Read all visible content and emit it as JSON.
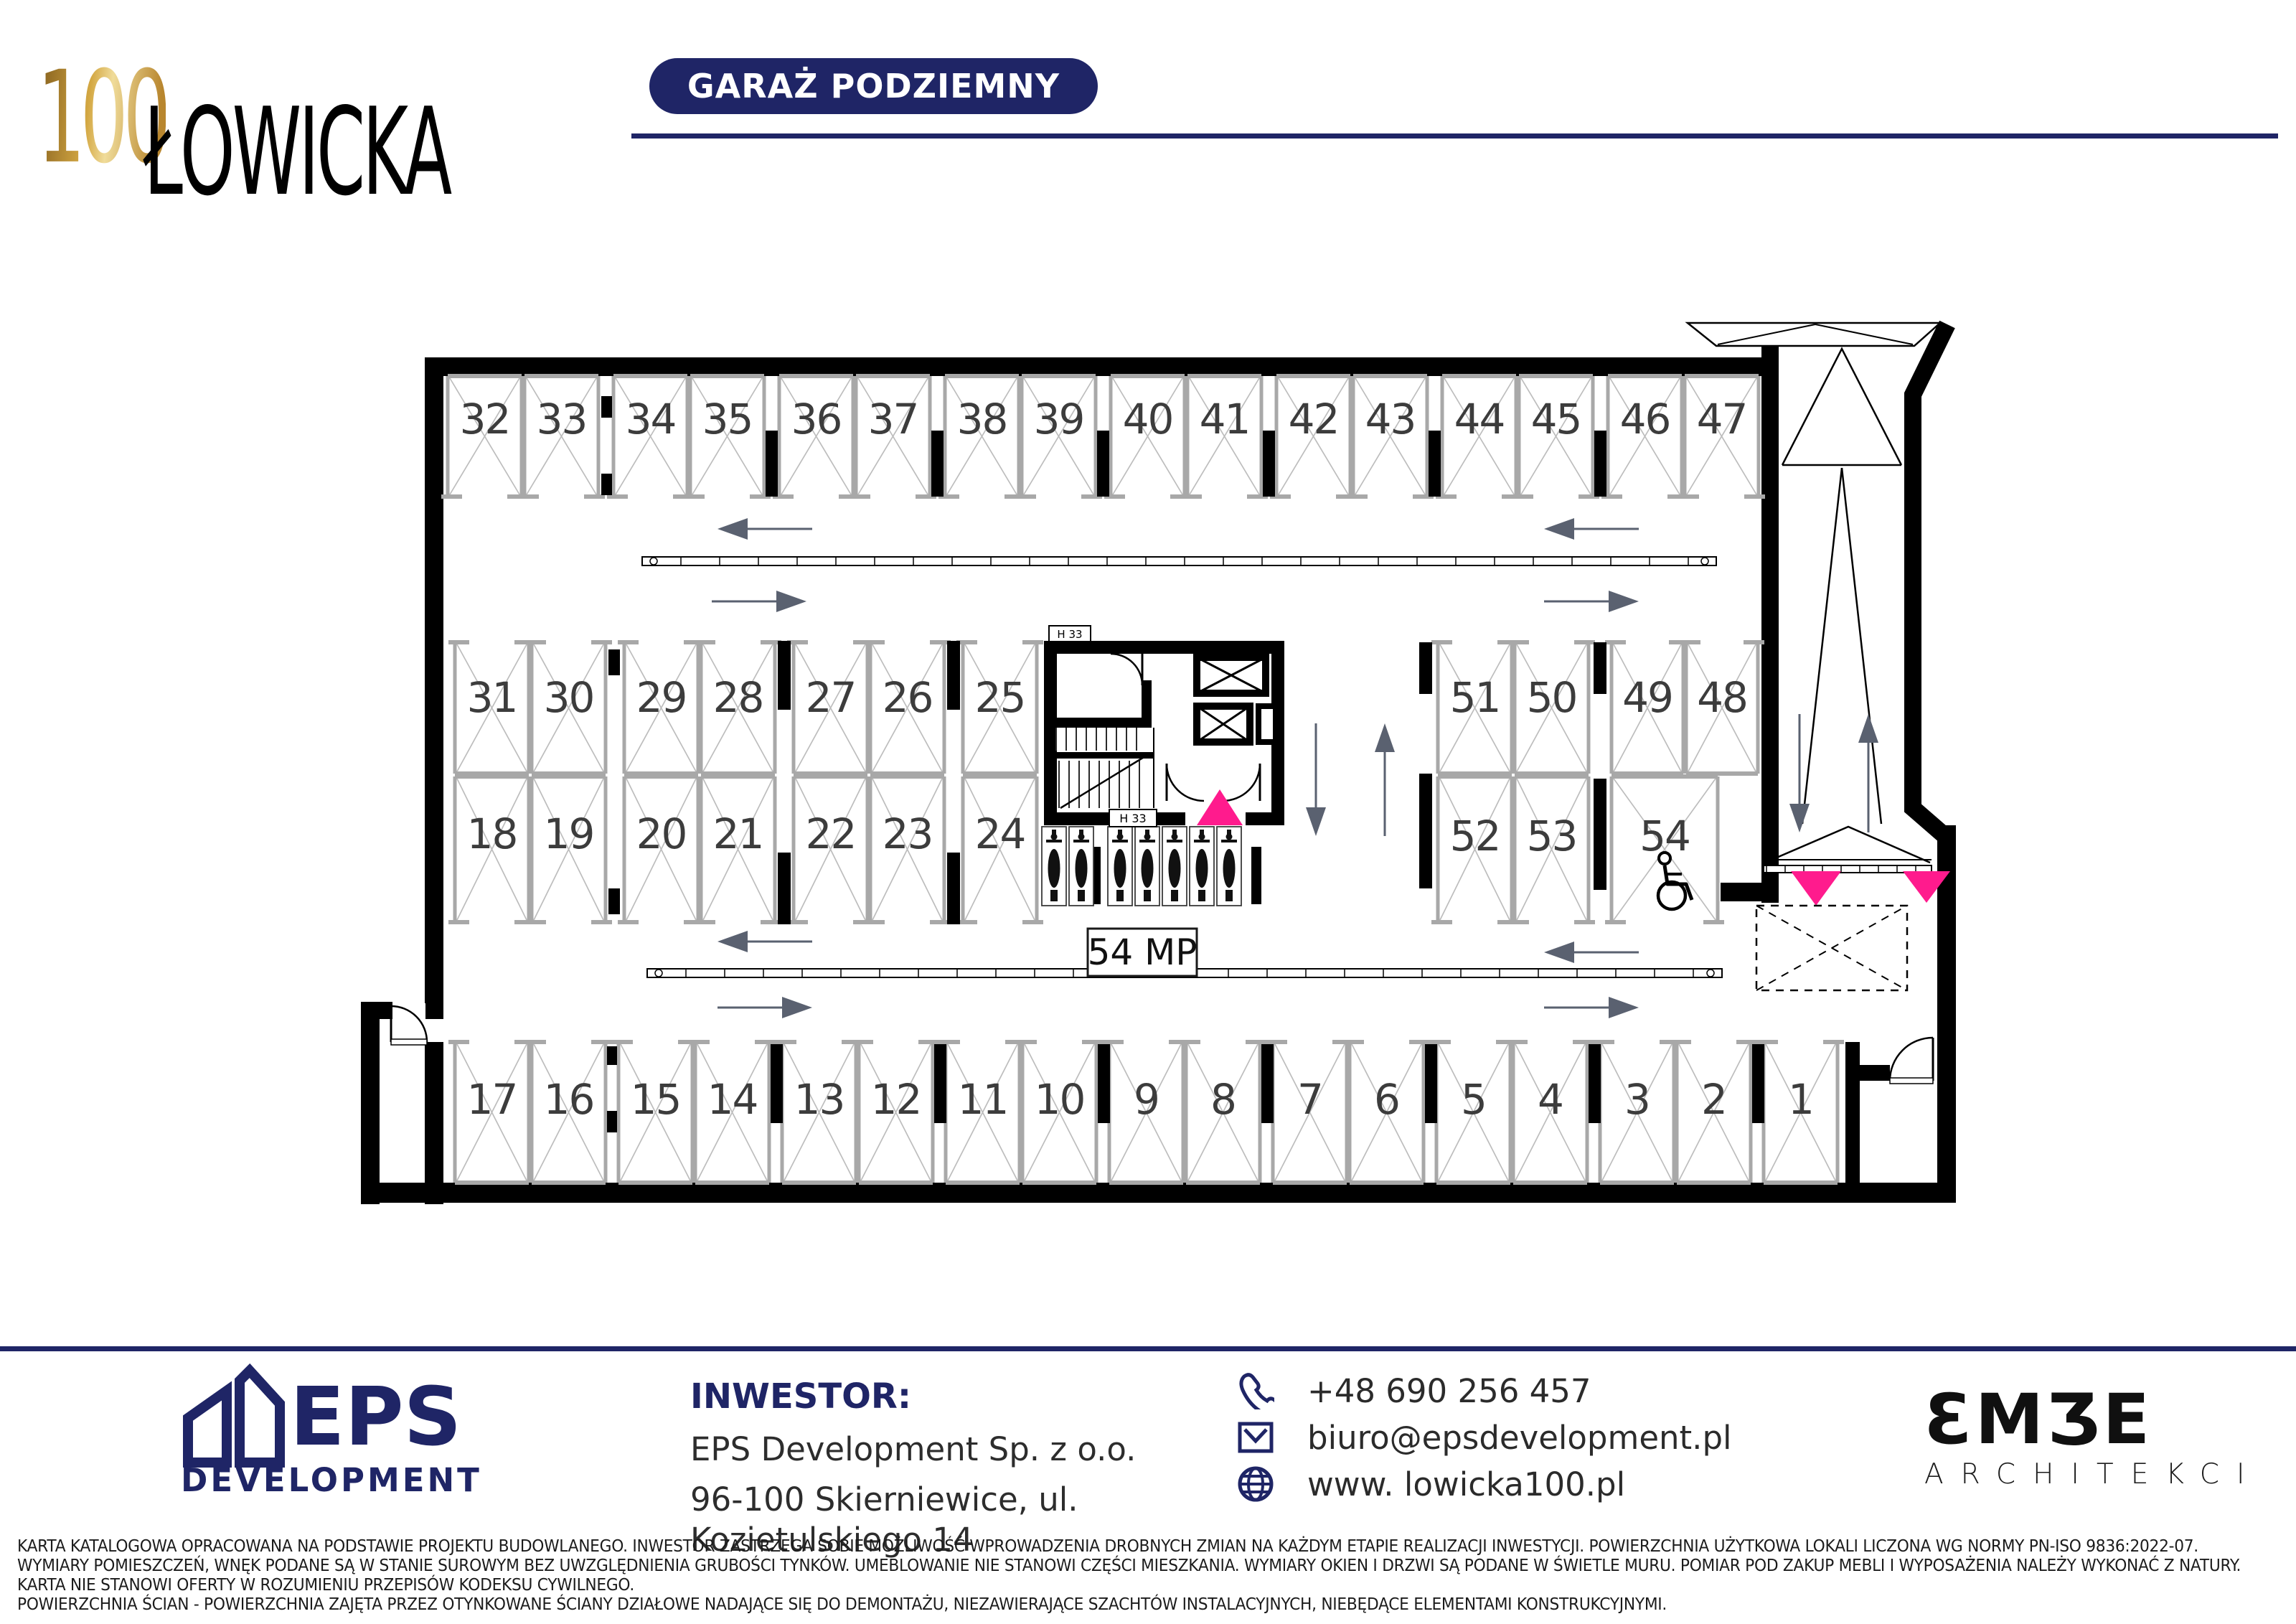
{
  "header": {
    "logo_number": "100",
    "logo_name": "ŁOWICKA",
    "badge": "GARAŻ PODZIEMNY"
  },
  "colors": {
    "navy": "#1f2566",
    "pink": "#ff1b8d",
    "wall": "#000000",
    "stall_frame": "#a8a8a8",
    "stall_diag": "#bdbdbd",
    "number": "#3c3c3c",
    "arrow": "#5a6170"
  },
  "plan": {
    "total_label": "54 MP",
    "core_labels": [
      "H 33",
      "H 33"
    ],
    "accessible_space": "54",
    "motorcycle_count": 7,
    "rows": {
      "top": [
        "32",
        "33",
        "34",
        "35",
        "36",
        "37",
        "38",
        "39",
        "40",
        "41",
        "42",
        "43",
        "44",
        "45",
        "46",
        "47"
      ],
      "mid_upper": [
        "31",
        "30",
        "29",
        "28",
        "27",
        "26",
        "25"
      ],
      "mid_lower": [
        "18",
        "19",
        "20",
        "21",
        "22",
        "23",
        "24"
      ],
      "right_upper": [
        "51",
        "50",
        "49",
        "48"
      ],
      "right_lower": [
        "52",
        "53",
        "54"
      ],
      "bottom": [
        "17",
        "16",
        "15",
        "14",
        "13",
        "12",
        "11",
        "10",
        "9",
        "8",
        "7",
        "6",
        "5",
        "4",
        "3",
        "2",
        "1"
      ]
    }
  },
  "footer": {
    "inwestor_label": "INWESTOR:",
    "company": "EPS Development Sp. z o.o.",
    "address": "96-100 Skierniewice, ul. Kozietulskiego 14",
    "eps_name": "EPS",
    "eps_sub": "DEVELOPMENT",
    "contacts": [
      {
        "icon": "phone-icon",
        "text": "+48 690 256 457"
      },
      {
        "icon": "email-icon",
        "text": "biuro@epsdevelopment.pl"
      },
      {
        "icon": "globe-icon",
        "text": "www. lowicka100.pl"
      }
    ],
    "embe_name": "EMBE",
    "embe_sub": "ARCHITEKCI"
  },
  "disclaimer": [
    "KARTA KATALOGOWA OPRACOWANA NA PODSTAWIE PROJEKTU BUDOWLANEGO. INWESTOR ZASTRZEGA SOBIE MOŻLIWOŚĆ WPROWADZENIA DROBNYCH ZMIAN NA KAŻDYM ETAPIE REALIZACJI INWESTYCJI. POWIERZCHNIA UŻYTKOWA LOKALI LICZONA WG NORMY PN-ISO 9836:2022-07.",
    "WYMIARY POMIESZCZEŃ, WNĘK PODANE SĄ W STANIE SUROWYM BEZ UWZGLĘDNIENIA GRUBOŚCI TYNKÓW. UMEBLOWANIE NIE STANOWI CZĘŚCI MIESZKANIA. WYMIARY OKIEN I DRZWI SĄ PODANE W ŚWIETLE MURU. POMIAR POD ZAKUP MEBLI I WYPOSAŻENIA NALEŻY WYKONAĆ Z NATURY.",
    "KARTA NIE STANOWI OFERTY W ROZUMIENIU PRZEPISÓW KODEKSU CYWILNEGO.",
    "POWIERZCHNIA ŚCIAN - POWIERZCHNIA ZAJĘTA PRZEZ OTYNKOWANE ŚCIANY DZIAŁOWE NADAJĄCE SIĘ DO DEMONTAŻU, NIEZAWIERAJĄCE SZACHTÓW INSTALACYJNYCH, NIEBĘDĄCE ELEMENTAMI KONSTRUKCYJNYMI."
  ]
}
